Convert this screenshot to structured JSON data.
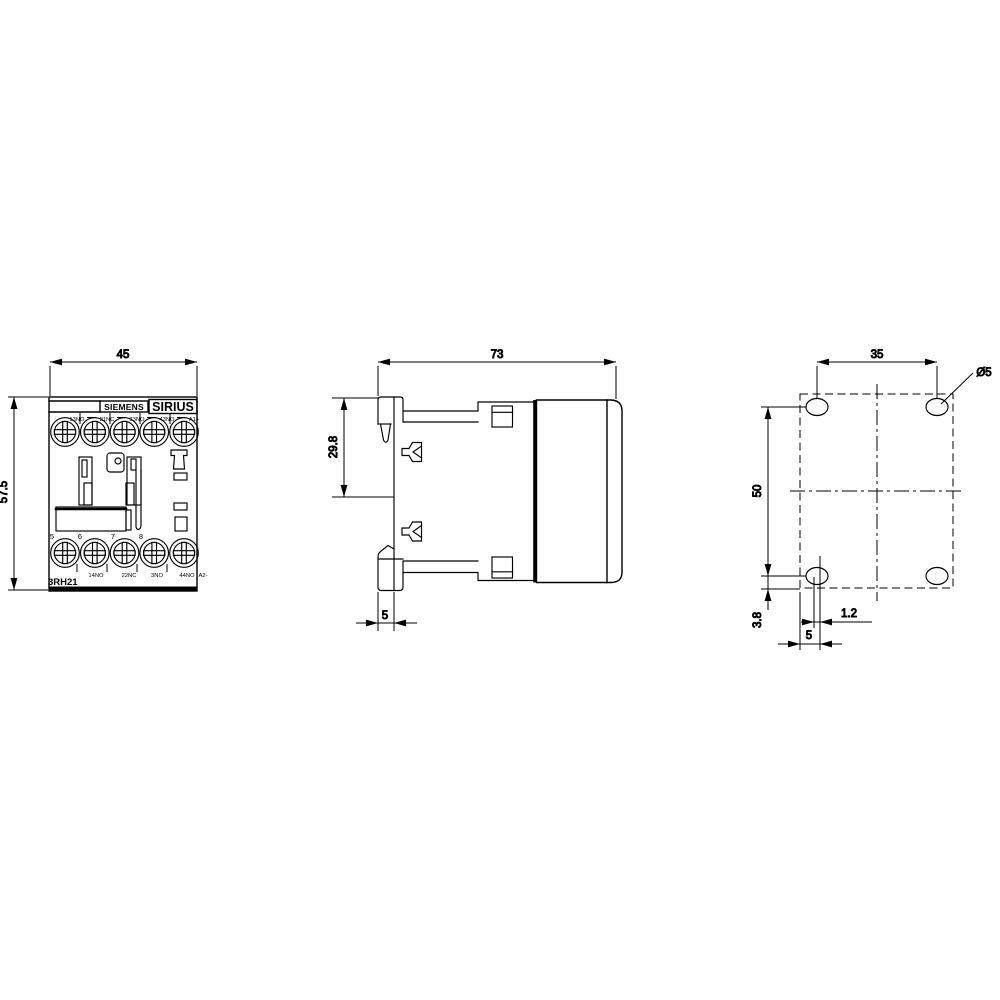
{
  "brand": "SIEMENS",
  "series": "SIRIUS",
  "model": "3RH21",
  "front_view": {
    "dim_width": "45",
    "dim_height": "57.5",
    "top_terminals": [
      "13NO",
      "21NC",
      "33NO",
      "43NO",
      "A1+"
    ],
    "bottom_terminals": [
      "14NO",
      "22NC",
      "3NO",
      "44NO",
      "A2-"
    ],
    "position_numbers": [
      "5",
      "6",
      "7",
      "8"
    ]
  },
  "side_view": {
    "dim_depth": "73",
    "dim_rail_height": "29.8",
    "dim_rail_depth": "5"
  },
  "drill_pattern_view": {
    "dim_hole_spacing_horizontal": "35",
    "dim_hole_spacing_vertical": "50",
    "dim_hole_diameter": "Ø5",
    "dim_bottom_offset": "3.8",
    "dim_slot_offset": "1.2",
    "dim_edge_distance": "5"
  },
  "colors": {
    "line": "#000000",
    "background": "#ffffff"
  }
}
